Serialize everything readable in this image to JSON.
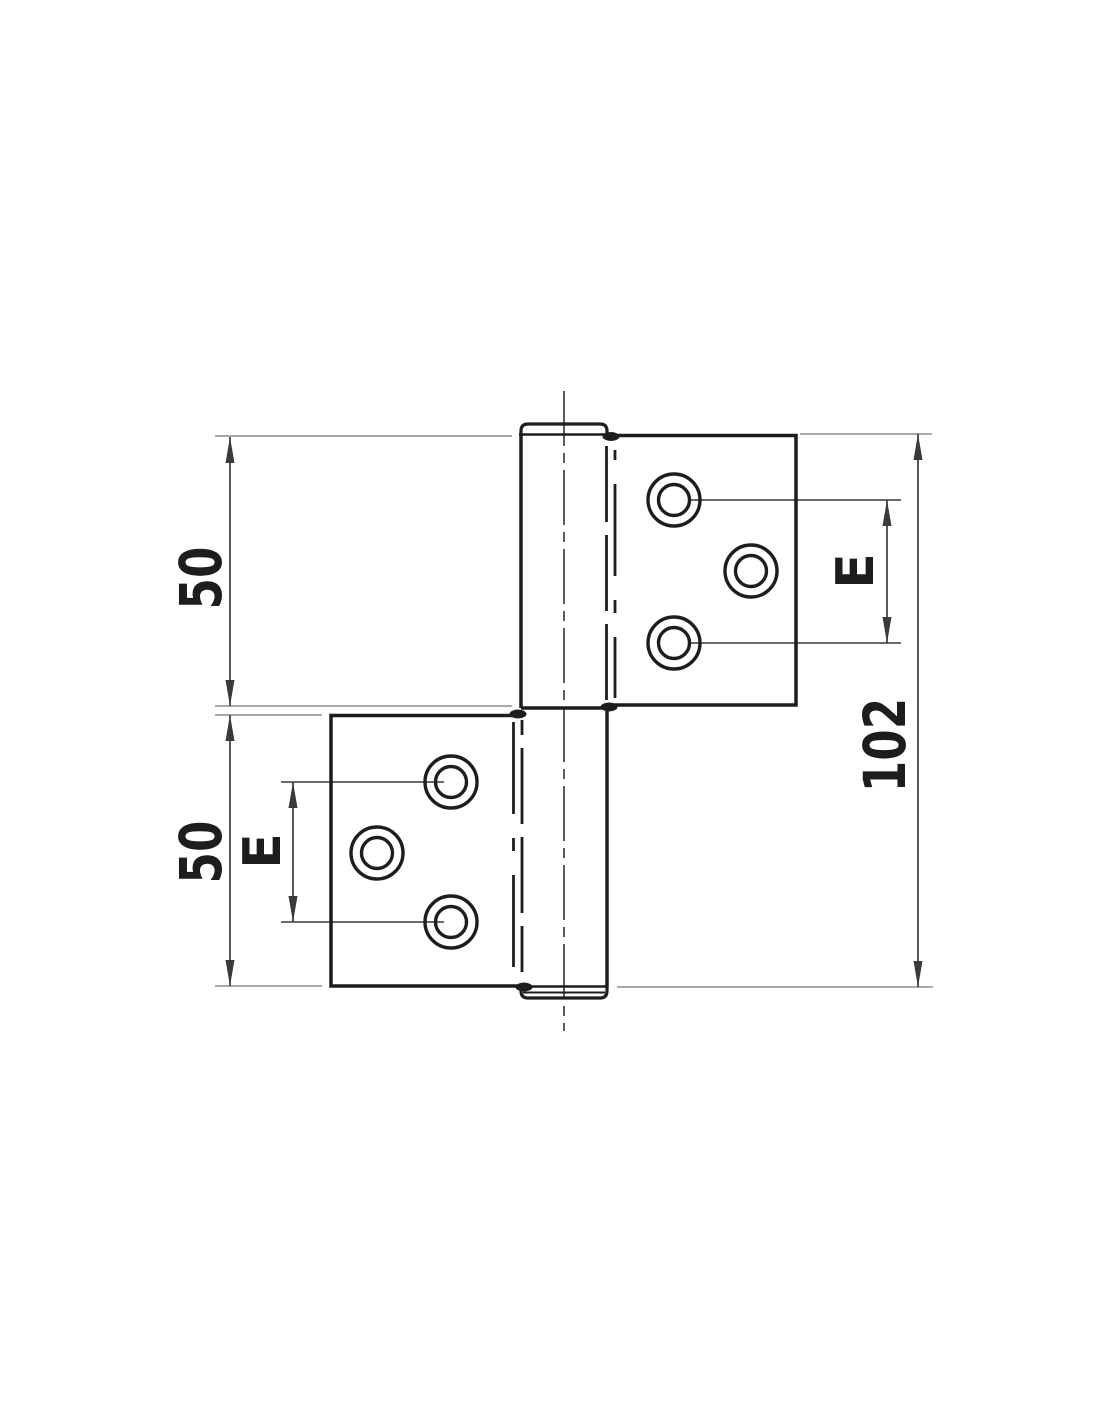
{
  "drawing": {
    "type": "technical-drawing",
    "subject": "flag hinge front elevation with two leaves, knuckle pin and screw holes",
    "background_color": "#ffffff",
    "outline_color": "#1d1d1b",
    "dim_color": "#3a3a39",
    "extension_color": "#9d9d9c",
    "centerline_color": "#4a4a49",
    "labels": {
      "upper_leaf_height": "50",
      "lower_leaf_height": "50",
      "overall_height": "102",
      "upper_hole_spacing": "E",
      "lower_hole_spacing": "E"
    }
  }
}
